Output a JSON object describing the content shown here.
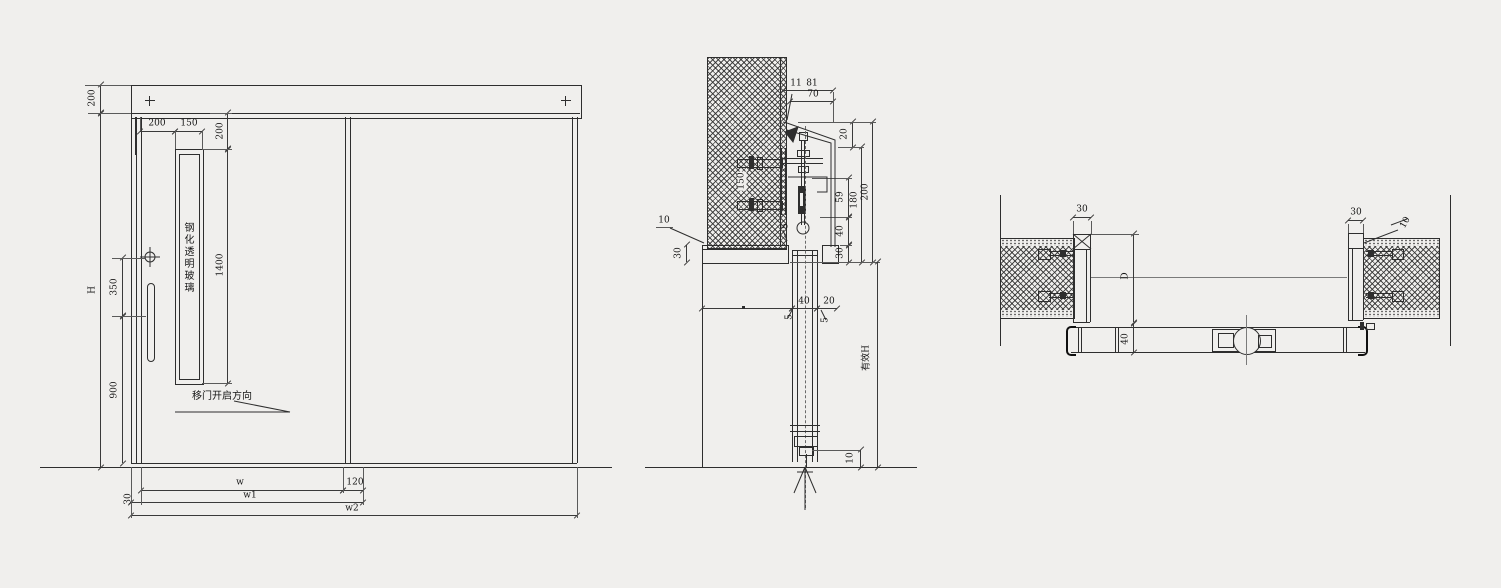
{
  "meta": {
    "background": "#f0efed",
    "line_color": "#2e2e2e"
  },
  "elevation": {
    "labels": {
      "glass": "钢化透明玻璃",
      "direction": "移门开启方向"
    },
    "dims": {
      "rail_h": "200",
      "h_total": "H",
      "handle_350": "350",
      "bottom_900": "900",
      "top_left_200": "200",
      "vision_w_150": "150",
      "vision_top_200": "200",
      "vision_h_1400": "1400",
      "leaf_w": "w",
      "overlap_120": "120",
      "w1": "w1",
      "w2": "w2",
      "edge_30": "30"
    }
  },
  "section": {
    "labels": {
      "effective_h": "有效H"
    },
    "dims": {
      "tip_11": "11",
      "top_81": "81",
      "top_70": "70",
      "right_20": "20",
      "right_59": "59",
      "right_40": "40",
      "right_30": "30",
      "right_180": "180",
      "right_200": "200",
      "left_10": "10",
      "left_30": "30",
      "bracket_150": "150",
      "leaf_40": "40",
      "gap_20": "20",
      "gap5_a": "5",
      "gap5_b": "5",
      "gap5_c": "5",
      "floor_10": "10"
    }
  },
  "plan": {
    "dims": {
      "jamb_l_30": "30",
      "opening_d": "D",
      "leaf_40": "40",
      "jamb_r_30": "30",
      "leader_10": "10"
    }
  }
}
